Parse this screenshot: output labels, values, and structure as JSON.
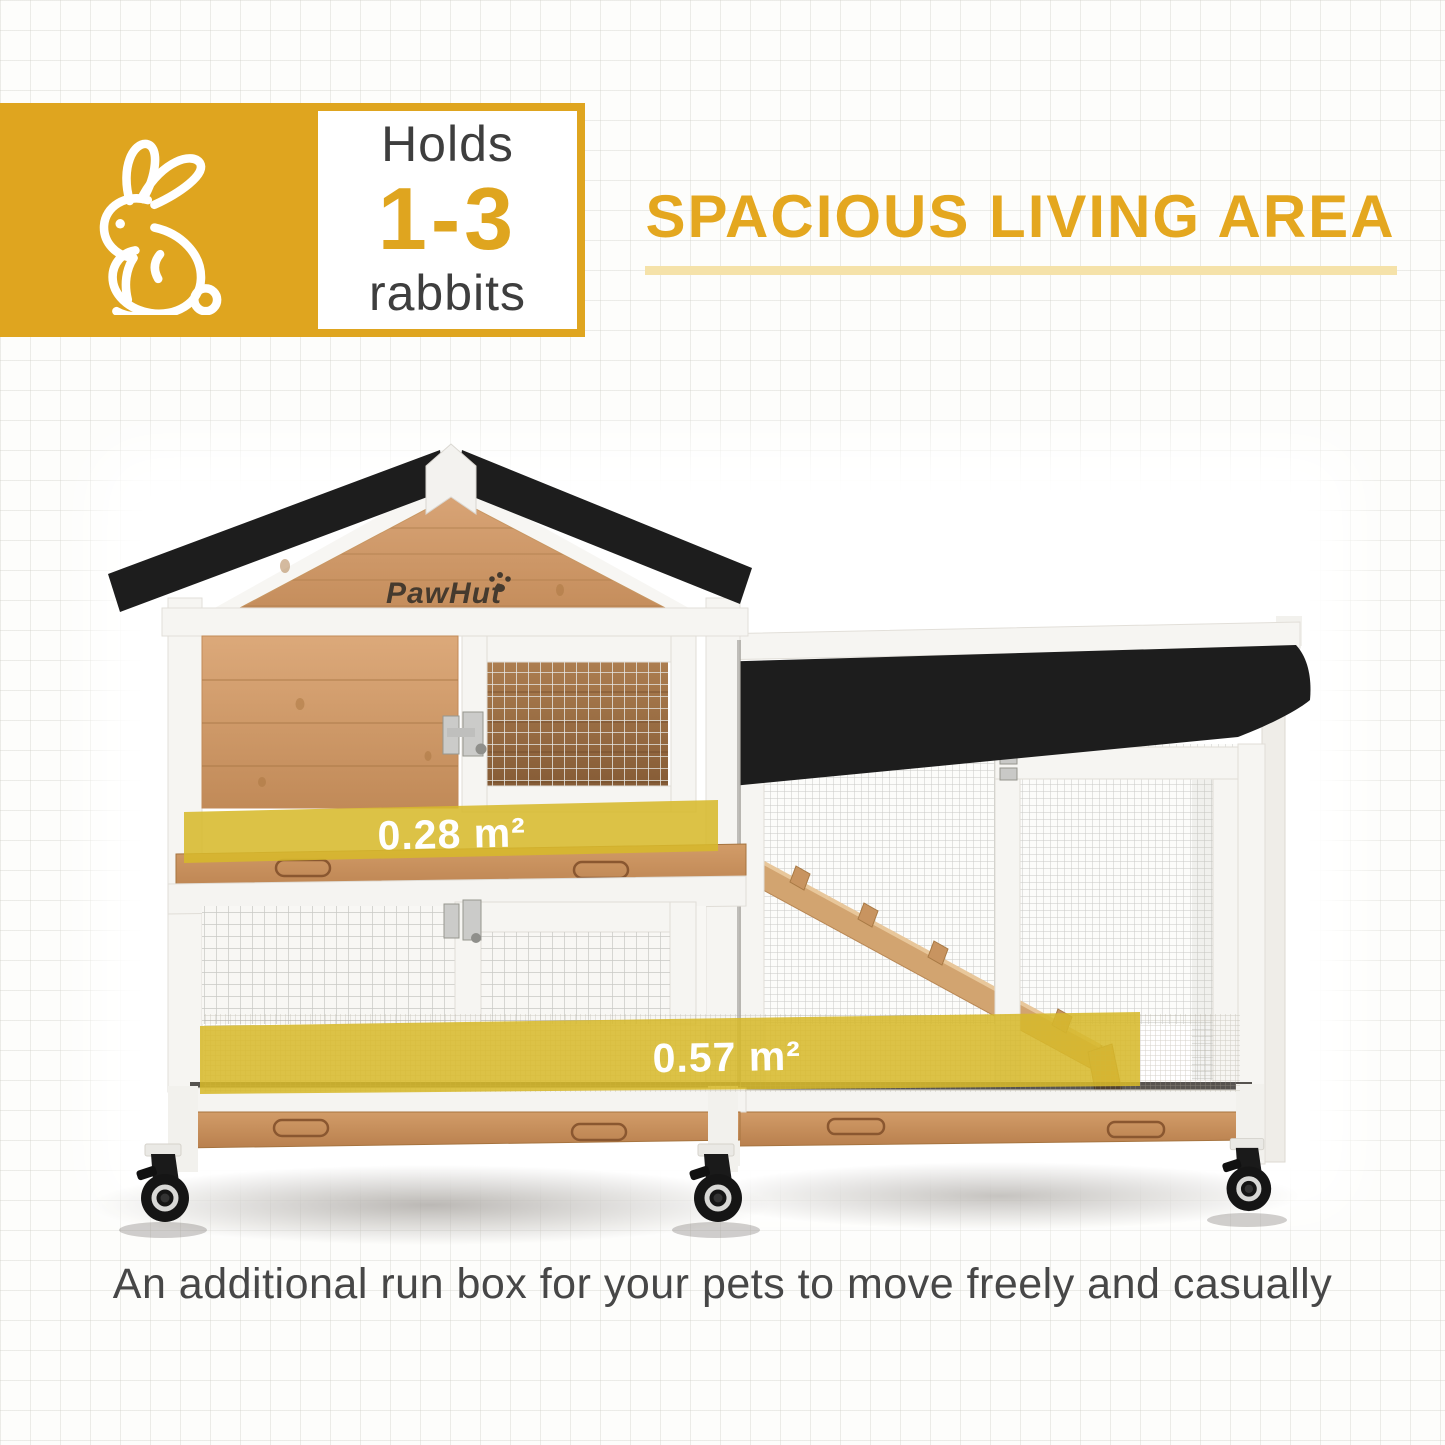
{
  "badge": {
    "icon": "rabbit-icon",
    "prefix": "Holds",
    "range": "1-3",
    "suffix": "rabbits",
    "accent_color": "#DFA51F"
  },
  "heading": {
    "title": "SPACIOUS LIVING AREA",
    "color": "#E4A71F",
    "underline_color": "#F5E2A9"
  },
  "product": {
    "brand": "PawHut",
    "area_labels": [
      {
        "text": "0.28 m²"
      },
      {
        "text": "0.57 m²"
      }
    ],
    "highlight_color": "#D7B92B",
    "roof_color": "#1D1D1D",
    "wood_color": "#C9935F",
    "frame_color": "#F5F4F1"
  },
  "caption": {
    "text": "An additional run box for your pets to move freely and casually"
  }
}
